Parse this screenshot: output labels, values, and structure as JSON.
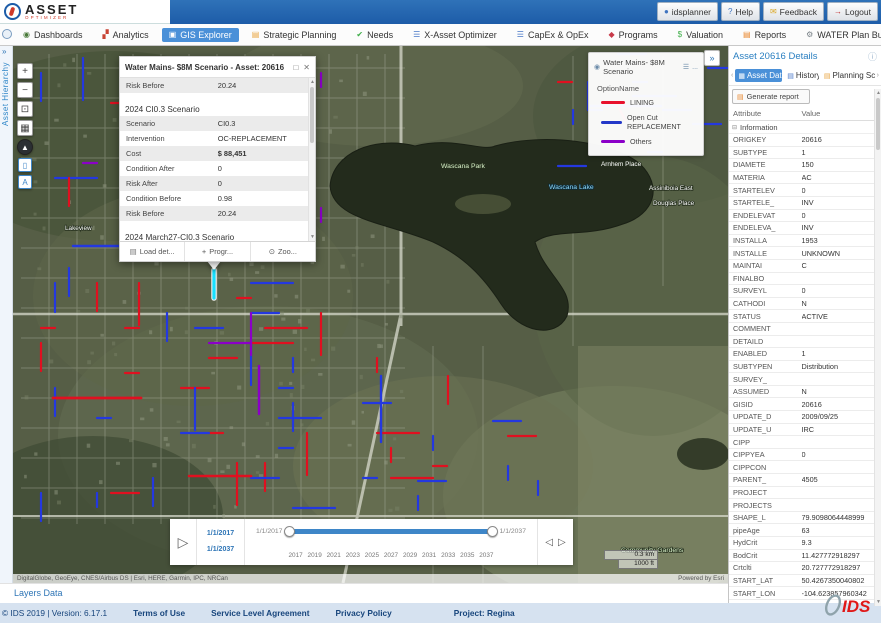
{
  "header": {
    "logo_line1": "ASSET",
    "logo_line2": "OPTIMIZER",
    "buttons": [
      {
        "label": "idsplanner",
        "icon": "user-icon"
      },
      {
        "label": "Help",
        "icon": "help-icon"
      },
      {
        "label": "Feedback",
        "icon": "feedback-icon"
      },
      {
        "label": "Logout",
        "icon": "logout-icon"
      }
    ]
  },
  "nav": {
    "tabs": [
      {
        "label": "Dashboards",
        "icon": "dashboards-icon",
        "active": false,
        "closable": false
      },
      {
        "label": "Analytics",
        "icon": "analytics-icon",
        "active": false,
        "closable": false
      },
      {
        "label": "GIS Explorer",
        "icon": "gis-explorer-icon",
        "active": true,
        "closable": false
      },
      {
        "label": "Strategic Planning",
        "icon": "strategic-planning-icon",
        "active": false,
        "closable": false
      },
      {
        "label": "Needs",
        "icon": "needs-icon",
        "active": false,
        "closable": false
      },
      {
        "label": "X-Asset Optimizer",
        "icon": "x-asset-optimizer-icon",
        "active": false,
        "closable": false
      },
      {
        "label": "CapEx & OpEx",
        "icon": "capex-opex-icon",
        "active": false,
        "closable": false
      },
      {
        "label": "Programs",
        "icon": "programs-icon",
        "active": false,
        "closable": false
      },
      {
        "label": "Valuation",
        "icon": "valuation-icon",
        "active": false,
        "closable": false
      },
      {
        "label": "Reports",
        "icon": "reports-icon",
        "active": false,
        "closable": false
      },
      {
        "label": "WATER Plan Builder",
        "icon": "water-plan-builder-icon",
        "active": false,
        "closable": true
      }
    ]
  },
  "left_rail": {
    "label": "Asset Hierarchy"
  },
  "map": {
    "attribution": "DigitalGlobe, GeoEye, CNES/Airbus DS | Esri, HERE, Garmin, IPC, NRCan",
    "powered_by": "Powered by Esri",
    "scale_km": "0.3 km",
    "scale_ft": "1000 ft",
    "layers_link": "Layers Data",
    "labels": [
      {
        "text": "Wascana Park",
        "x": 428,
        "y": 122,
        "type": "park"
      },
      {
        "text": "Wascana Lake",
        "x": 536,
        "y": 143,
        "type": "water"
      },
      {
        "text": "Arnhem Place",
        "x": 588,
        "y": 120,
        "type": "place"
      },
      {
        "text": "Assiniboia East",
        "x": 636,
        "y": 144,
        "type": "place"
      },
      {
        "text": "Douglas Place",
        "x": 640,
        "y": 159,
        "type": "place"
      },
      {
        "text": "Lakeview",
        "x": 52,
        "y": 184,
        "type": "place"
      },
      {
        "text": "Community Gardens",
        "x": 608,
        "y": 506,
        "type": "park"
      }
    ],
    "controls": [
      {
        "name": "zoom-in-button",
        "icon": "plus-icon"
      },
      {
        "name": "zoom-out-button",
        "icon": "minus-icon"
      },
      {
        "name": "home-extent-button",
        "icon": "extent-icon"
      },
      {
        "name": "basemap-button",
        "icon": "basemap-icon"
      },
      {
        "name": "compass-button",
        "icon": "compass-icon"
      },
      {
        "name": "select-tool-button",
        "icon": "select-icon"
      },
      {
        "name": "attribute-tool-button",
        "icon": "attribute-icon"
      }
    ]
  },
  "legend": {
    "title": "Water Mains- $8M Scenario",
    "field": "OptionName",
    "entries": [
      {
        "label": "LINING",
        "color": "#e8112d"
      },
      {
        "label": "Open Cut REPLACEMENT",
        "color": "#2438c8"
      },
      {
        "label": "Others",
        "color": "#8b00c8"
      }
    ]
  },
  "popup": {
    "title": "Water Mains- $8M Scenario - Asset: 20616",
    "pre_rows": [
      {
        "label": "Risk Before",
        "value": "20.24"
      }
    ],
    "sections": [
      {
        "title": "2024 CI0.3 Scenario",
        "rows": [
          {
            "label": "Scenario",
            "value": "CI0.3"
          },
          {
            "label": "Intervention",
            "value": "OC-REPLACEMENT"
          },
          {
            "label": "Cost",
            "value": "$ 88,451",
            "bold": true
          },
          {
            "label": "Condition After",
            "value": "0"
          },
          {
            "label": "Risk After",
            "value": "0"
          },
          {
            "label": "Condition Before",
            "value": "0.98"
          },
          {
            "label": "Risk Before",
            "value": "20.24"
          }
        ]
      },
      {
        "title": "2024 March27-CI0.3 Scenario",
        "rows": []
      }
    ],
    "actions": [
      {
        "label": "Load det...",
        "icon": "document-icon",
        "name": "load-details-button"
      },
      {
        "label": "Progr...",
        "icon": "plus-icon",
        "name": "program-button"
      },
      {
        "label": "Zoo...",
        "icon": "magnifier-icon",
        "name": "zoom-to-button"
      }
    ]
  },
  "timeline": {
    "range_start": "1/1/2017",
    "range_end": "1/1/2037",
    "left_label": "1/1/2017",
    "right_label": "1/1/2037",
    "ticks": [
      "2017",
      "2019",
      "2021",
      "2023",
      "2025",
      "2027",
      "2029",
      "2031",
      "2033",
      "2035",
      "2037"
    ]
  },
  "details_panel": {
    "title": "Asset 20616 Details",
    "tabs": [
      {
        "label": "Asset Data",
        "icon": "asset-data-icon",
        "active": true
      },
      {
        "label": "History",
        "icon": "history-icon",
        "active": false
      },
      {
        "label": "Planning Sce",
        "icon": "planning-icon",
        "active": false
      }
    ],
    "generate_report": "Generate report",
    "columns": [
      "Attribute",
      "Value"
    ],
    "section": "Information",
    "rows": [
      {
        "a": "ORIGKEY",
        "v": "20616"
      },
      {
        "a": "SUBTYPE",
        "v": "1"
      },
      {
        "a": "DIAMETE",
        "v": "150"
      },
      {
        "a": "MATERIA",
        "v": "AC"
      },
      {
        "a": "STARTELEV",
        "v": "0"
      },
      {
        "a": "STARTELE_",
        "v": "INV"
      },
      {
        "a": "ENDELEVAT",
        "v": "0"
      },
      {
        "a": "ENDELEVA_",
        "v": "INV"
      },
      {
        "a": "INSTALLA",
        "v": "1953"
      },
      {
        "a": "INSTALLE",
        "v": "UNKNOWN"
      },
      {
        "a": "MAINTAI",
        "v": "C"
      },
      {
        "a": "FINALBO",
        "v": ""
      },
      {
        "a": "SURVEYL",
        "v": "0"
      },
      {
        "a": "CATHODI",
        "v": "N"
      },
      {
        "a": "STATUS",
        "v": "ACTIVE"
      },
      {
        "a": "COMMENT",
        "v": ""
      },
      {
        "a": "DETAILD",
        "v": ""
      },
      {
        "a": "ENABLED",
        "v": "1"
      },
      {
        "a": "SUBTYPEN",
        "v": "Distribution"
      },
      {
        "a": "SURVEY_",
        "v": ""
      },
      {
        "a": "ASSUMED",
        "v": "N"
      },
      {
        "a": "GISID",
        "v": "20616"
      },
      {
        "a": "UPDATE_D",
        "v": "2009/09/25"
      },
      {
        "a": "UPDATE_U",
        "v": "IRC"
      },
      {
        "a": "CIPP",
        "v": ""
      },
      {
        "a": "CIPPYEA",
        "v": "0"
      },
      {
        "a": "CIPPCON",
        "v": ""
      },
      {
        "a": "PARENT_",
        "v": "4505"
      },
      {
        "a": "PROJECT",
        "v": ""
      },
      {
        "a": "PROJECTS",
        "v": ""
      },
      {
        "a": "SHAPE_L",
        "v": "79.9098064448999"
      },
      {
        "a": "pipeAge",
        "v": "63"
      },
      {
        "a": "HydCrit",
        "v": "9.3"
      },
      {
        "a": "BodCrit",
        "v": "11.427772918297"
      },
      {
        "a": "Crtclti",
        "v": "20.727772918297"
      },
      {
        "a": "START_LAT",
        "v": "50.4267350040802"
      },
      {
        "a": "START_LON",
        "v": "-104.623857960342"
      }
    ]
  },
  "footer": {
    "copyright": "© IDS 2019 | Version: 6.17.1",
    "links": [
      "Terms of Use",
      "Service Level Agreement",
      "Privacy Policy"
    ],
    "project": "Project: Regina",
    "brand": "IDS"
  }
}
